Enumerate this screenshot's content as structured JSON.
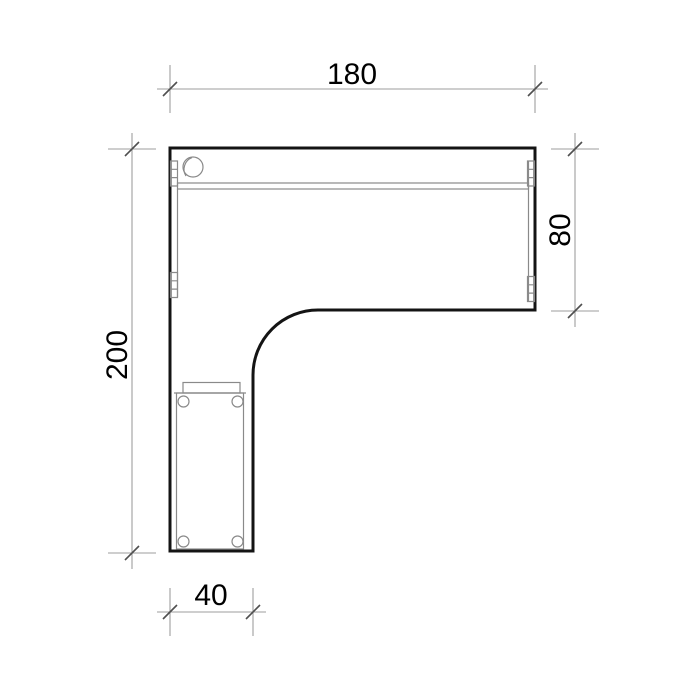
{
  "drawing": {
    "type": "furniture-plan",
    "subject": "L-shaped corner desk, top view with pedestal and dimensions",
    "dimensions": {
      "top_width": {
        "label": "180"
      },
      "right_depth": {
        "label": "80"
      },
      "left_height": {
        "label": "200"
      },
      "bottom_width": {
        "label": "40"
      }
    },
    "colors": {
      "background": "#ffffff",
      "outline": "#141414",
      "detail_line": "#8a8a8a",
      "dimension_line": "#9e9e9e",
      "tick_mark": "#4f4f4f",
      "text": "#000000"
    }
  }
}
